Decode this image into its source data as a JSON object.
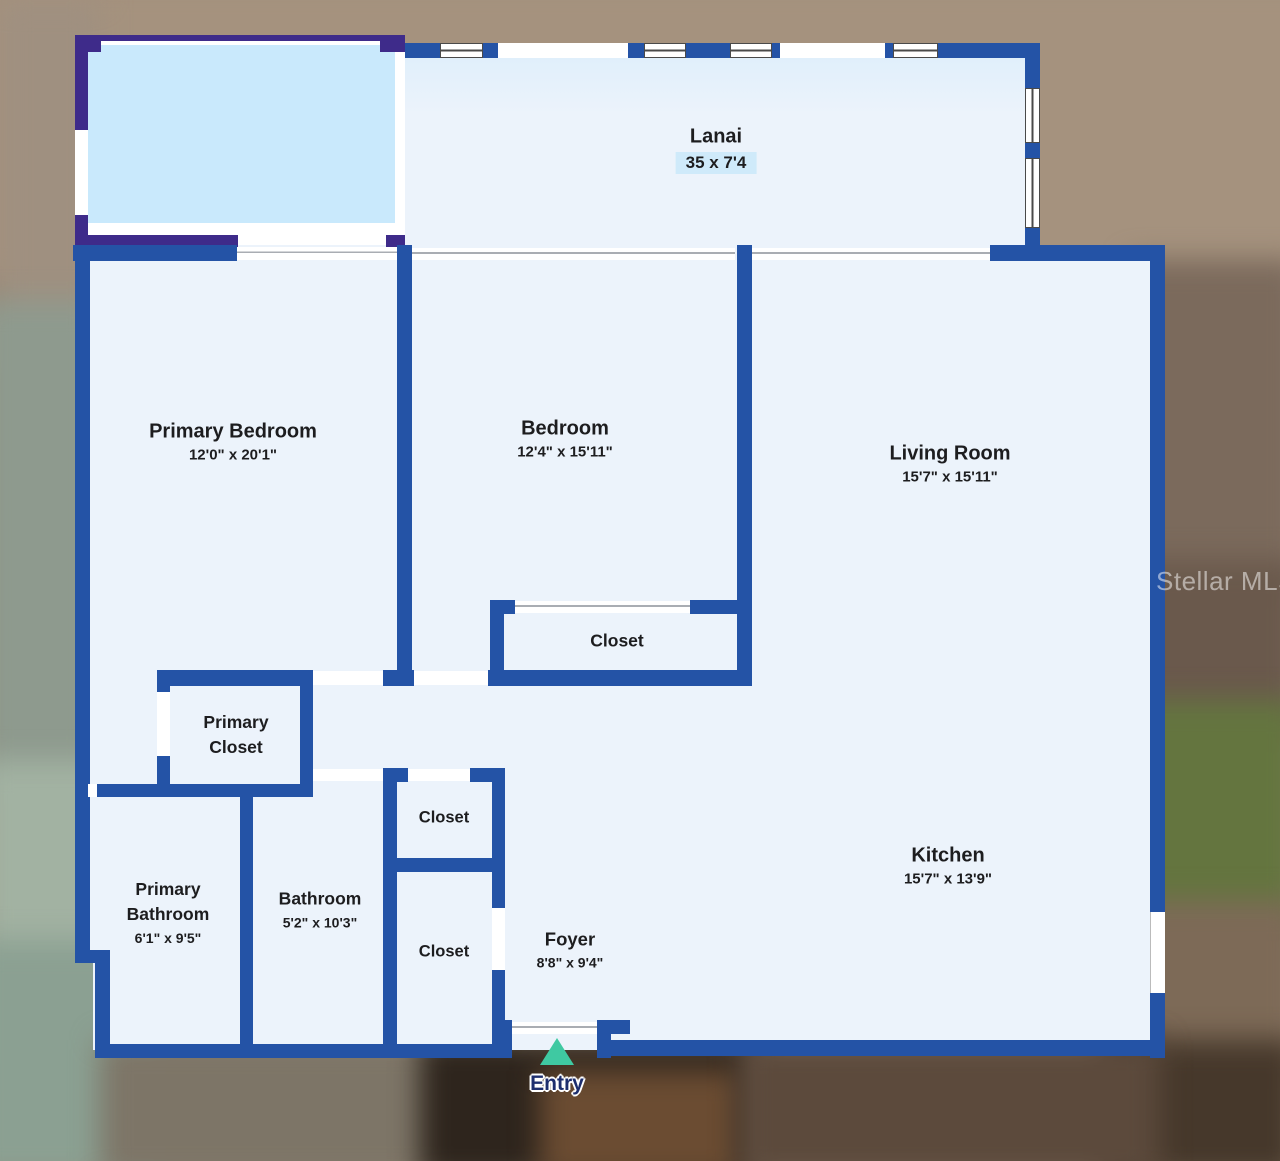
{
  "watermark": "Stellar MLS",
  "entry": {
    "label": "Entry"
  },
  "rooms": {
    "lanai": {
      "name": "Lanai",
      "dims": "35 x 7'4"
    },
    "primary_bedroom": {
      "name": "Primary Bedroom",
      "dims": "12'0\" x 20'1\""
    },
    "bedroom": {
      "name": "Bedroom",
      "dims": "12'4\" x 15'11\""
    },
    "living_room": {
      "name": "Living Room",
      "dims": "15'7\" x 15'11\""
    },
    "bedroom_closet": {
      "name": "Closet"
    },
    "primary_closet": {
      "name": "Primary Closet"
    },
    "primary_bathroom": {
      "name": "Primary Bathroom",
      "dims": "6'1\" x 9'5\""
    },
    "bathroom": {
      "name": "Bathroom",
      "dims": "5'2\" x 10'3\""
    },
    "hall_closet_upper": {
      "name": "Closet"
    },
    "hall_closet_lower": {
      "name": "Closet"
    },
    "foyer": {
      "name": "Foyer",
      "dims": "8'8\" x 9'4\""
    },
    "kitchen": {
      "name": "Kitchen",
      "dims": "15'7\" x 13'9\""
    }
  },
  "colors": {
    "wall": "#2453a6",
    "patio_wall": "#3e2b8a",
    "room_fill": "#ecf3fb",
    "pool_fill": "#c9e9fc",
    "lanai_dims_bg": "#cfeafa",
    "entry_marker": "#3fc9a2",
    "entry_text": "#1d2e6e",
    "label_text": "#1d1d1f",
    "watermark_text": "rgba(255,255,255,0.5)"
  }
}
